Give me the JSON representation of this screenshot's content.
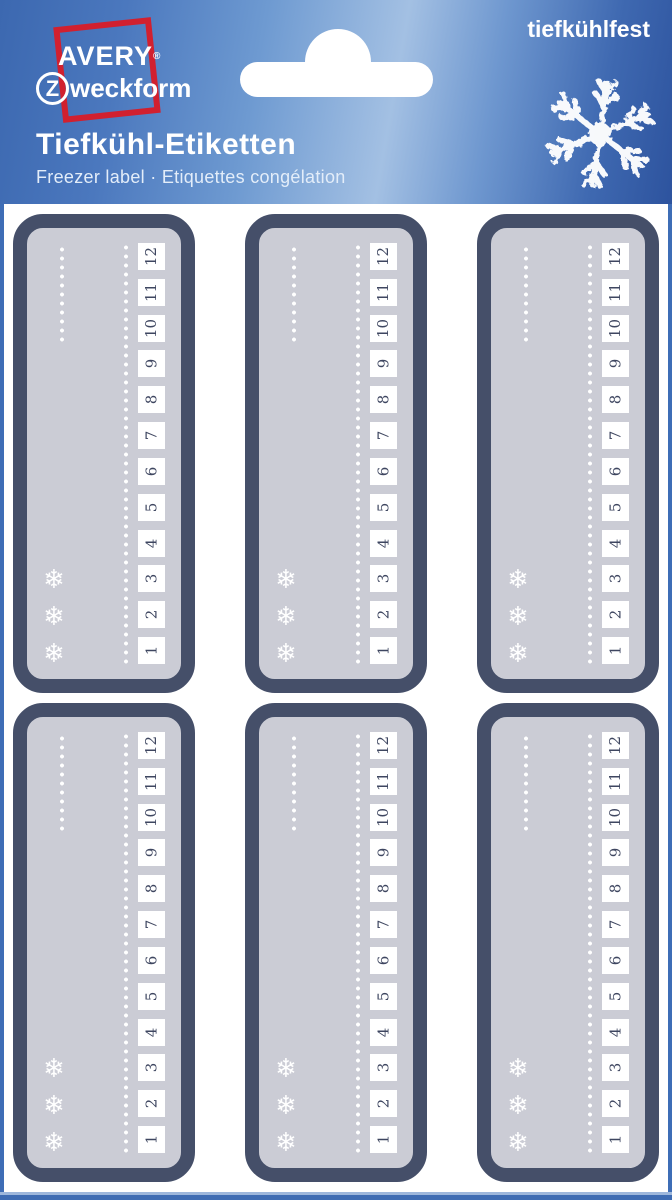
{
  "brand": {
    "avery": "AVERY",
    "registered": "®",
    "z_letter": "Z",
    "zweckform_rest": "weckform",
    "frame_color": "#d1202f"
  },
  "header": {
    "claim": "tiefkühlfest",
    "title": "Tiefkühl-Etiketten",
    "subtitle": "Freezer label · Etiquettes congélation"
  },
  "sheet": {
    "rows": 2,
    "columns": 3,
    "label": {
      "numbers_top_to_bottom": [
        "12",
        "11",
        "10",
        "9",
        "8",
        "7",
        "6",
        "5",
        "4",
        "3",
        "2",
        "1"
      ],
      "snowflake_glyph": "❄",
      "snowflake_count": 3
    }
  },
  "colors": {
    "header_blue_dark": "#2d539e",
    "header_blue_light": "#a3c0e3",
    "frame_blue": "#3e6db6",
    "label_border_navy": "#454f69",
    "label_fill": "#cbccd5",
    "number_box_fill": "#ffffff",
    "number_text": "#3e4660",
    "logo_red": "#d1202f",
    "white": "#ffffff"
  }
}
